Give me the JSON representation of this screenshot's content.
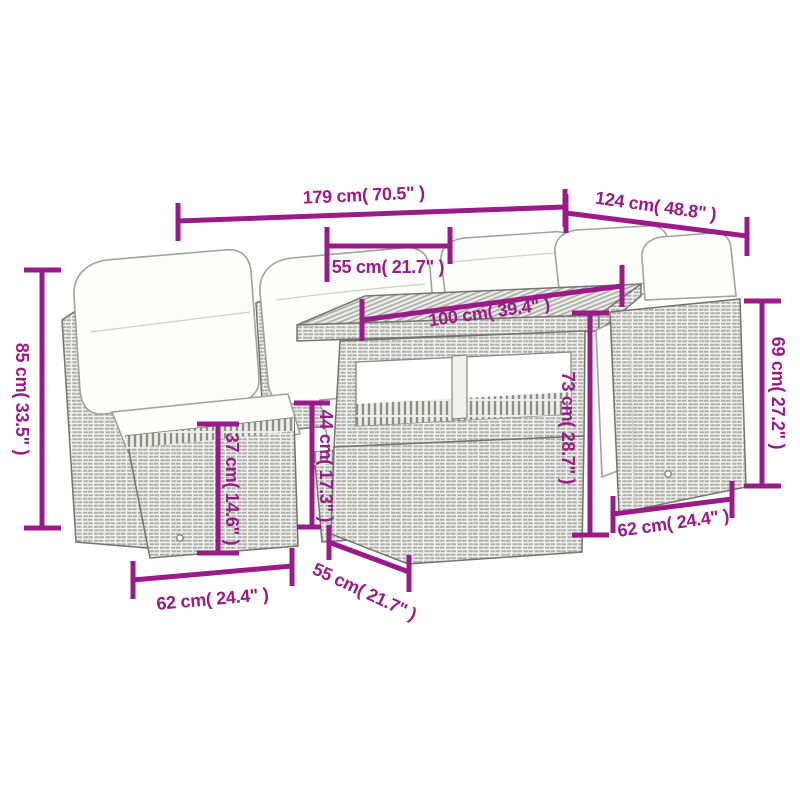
{
  "diagram": {
    "colors": {
      "accent": "#9a1b87",
      "background": "#ffffff",
      "line_art": "#75756f",
      "rattan_fill": "#f2f2f0",
      "rattan_weave": "#aeaeaa",
      "cushion": "#fdfdfb"
    },
    "dimensions": [
      {
        "id": "total-width",
        "label": "179 cm( 70.5\" )"
      },
      {
        "id": "total-depth",
        "label": "124 cm( 48.8\" )"
      },
      {
        "id": "backrest-height",
        "label": "85 cm( 33.5\" )"
      },
      {
        "id": "seat-width",
        "label": "55 cm( 21.7\" )"
      },
      {
        "id": "table-length",
        "label": "100 cm( 39.4\" )"
      },
      {
        "id": "side-back-height",
        "label": "69 cm( 27.2\" )"
      },
      {
        "id": "table-height",
        "label": "73 cm( 28.7\" )"
      },
      {
        "id": "seat-height",
        "label": "37 cm( 14.6\" )"
      },
      {
        "id": "section-height",
        "label": "44 cm( 17.3\" )"
      },
      {
        "id": "seat-depth-left",
        "label": "62 cm( 24.4\" )"
      },
      {
        "id": "table-width",
        "label": "55 cm( 21.7\" )"
      },
      {
        "id": "seat-depth-right",
        "label": "62 cm( 24.4\" )"
      }
    ]
  }
}
